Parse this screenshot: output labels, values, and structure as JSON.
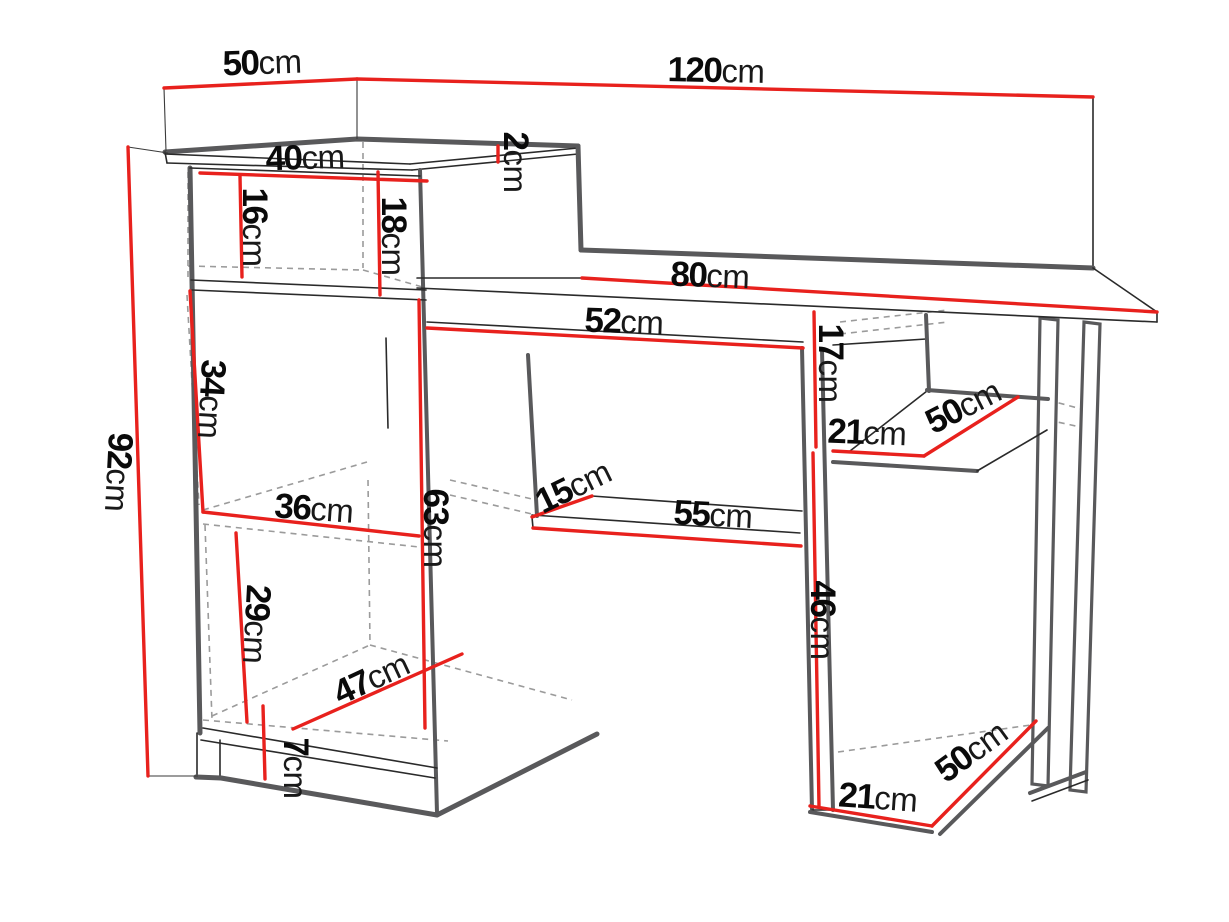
{
  "page": {
    "width": 1229,
    "height": 922,
    "background": "#ffffff"
  },
  "colors": {
    "dimension_line_red": "#e8211d",
    "outline_primary_gray": "#59595b",
    "outline_secondary_black": "#2a2a2a",
    "hidden_line_gray": "#9b9b9b",
    "label_text": "#0a0a0a"
  },
  "drawing": {
    "type": "furniture-dimension-diagram",
    "unit": "cm"
  },
  "dims": {
    "top_depth": {
      "value": "50",
      "unit": "cm"
    },
    "total_width": {
      "value": "120",
      "unit": "cm"
    },
    "hutch_width": {
      "value": "40",
      "unit": "cm"
    },
    "board_thickness": {
      "value": "2",
      "unit": "cm"
    },
    "hutch_inner_height": {
      "value": "16",
      "unit": "cm"
    },
    "hutch_outer_height": {
      "value": "18",
      "unit": "cm"
    },
    "desktop_width": {
      "value": "80",
      "unit": "cm"
    },
    "opening_width": {
      "value": "52",
      "unit": "cm"
    },
    "right_top_height": {
      "value": "17",
      "unit": "cm"
    },
    "door_section_height": {
      "value": "34",
      "unit": "cm"
    },
    "total_height": {
      "value": "92",
      "unit": "cm"
    },
    "middle_shelf_width": {
      "value": "36",
      "unit": "cm"
    },
    "lower_inner_height": {
      "value": "63",
      "unit": "cm"
    },
    "tray_depth": {
      "value": "15",
      "unit": "cm"
    },
    "tray_width": {
      "value": "55",
      "unit": "cm"
    },
    "upper_shelf_width": {
      "value": "21",
      "unit": "cm"
    },
    "upper_shelf_depth": {
      "value": "50",
      "unit": "cm"
    },
    "right_lower_height": {
      "value": "46",
      "unit": "cm"
    },
    "lower_section_height": {
      "value": "29",
      "unit": "cm"
    },
    "bottom_diagonal": {
      "value": "47",
      "unit": "cm"
    },
    "plinth_height": {
      "value": "7",
      "unit": "cm"
    },
    "bottom_shelf_width": {
      "value": "21",
      "unit": "cm"
    },
    "bottom_shelf_depth": {
      "value": "50",
      "unit": "cm"
    }
  }
}
